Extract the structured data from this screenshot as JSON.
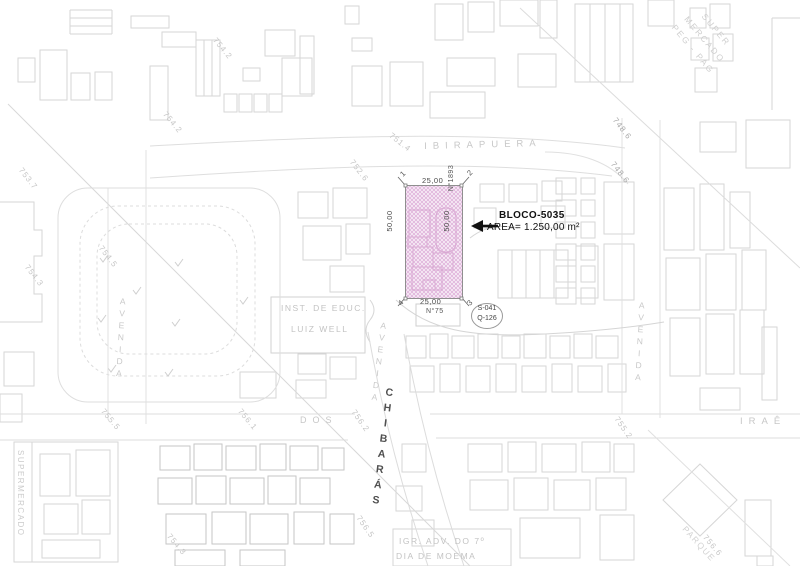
{
  "map": {
    "streets": {
      "ibirapuera": "IBIRAPUERA",
      "avenida_left": "AVENIDA",
      "avenida_mid": "AVENIDA",
      "avenida_right": "AVENIDA",
      "chibaras": "CHIBARÁS",
      "dos": "DOS",
      "irae": "IRAÊ"
    },
    "places": {
      "supermercado_left": "SUPERMERCADO",
      "super_mercado_line1": "SUPER",
      "super_mercado_line2": "MERCADO",
      "super_mercado_line3": "PEG - PAG",
      "inst_line1": "INST. DE EDUC.",
      "inst_line2": "LUIZ WELL",
      "igr_line1": "IGR. ADV. DO 7º",
      "igr_line2": "DIA DE MOEMA",
      "parque": "PARQUE"
    },
    "elevations": [
      "753.7",
      "754.2",
      "754.2",
      "751.4",
      "752.6",
      "748.6",
      "748.6",
      "754.5",
      "754.3",
      "755.5",
      "756.1",
      "756.2",
      "755.2",
      "754.3",
      "756.5",
      "756.6"
    ]
  },
  "lot": {
    "block_label": "BLOCO-5035",
    "area_label": "AREA= 1.250,00 m²",
    "dim_top": "25,00",
    "dim_bottom": "25,00",
    "dim_left": "50,00",
    "dim_right": "50,00",
    "corners": [
      "1",
      "2",
      "3",
      "4"
    ],
    "house_number_right": "N°1893",
    "house_number_bottom": "N°75",
    "sector_label": "S-041",
    "quadra_label": "Q-126"
  },
  "colors": {
    "highlight_fill": "#f7ecf6",
    "highlight_hatch": "#dcabd7",
    "highlight_outline": "#8f8f8f",
    "linework": "#d6d6d6",
    "callout_ink": "#111111"
  }
}
